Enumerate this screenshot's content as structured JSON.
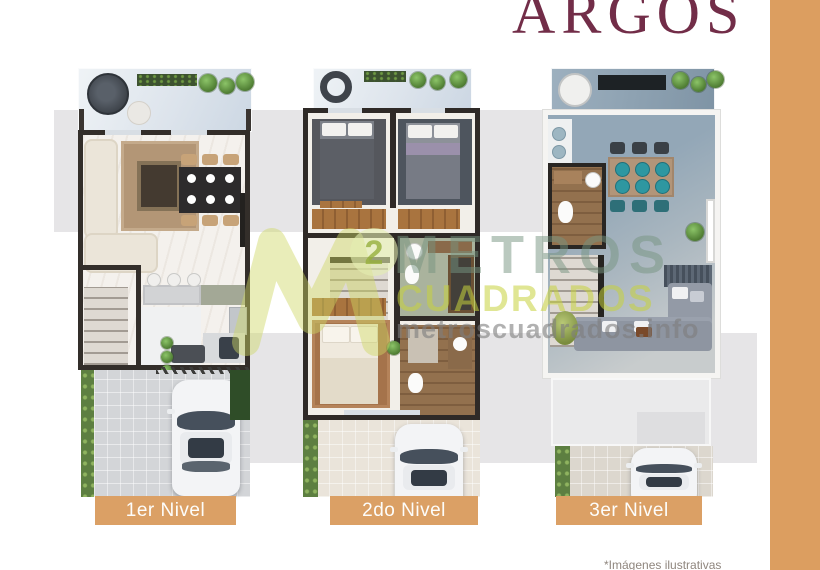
{
  "title": {
    "text": "ARGOS"
  },
  "watermark": {
    "logo_sup": "2",
    "line1": "METROS",
    "line2": "CUADRADOS",
    "url": "metroscuadrados.info"
  },
  "plans": [
    {
      "label": "1er Nivel"
    },
    {
      "label": "2do Nivel"
    },
    {
      "label": "3er Nivel"
    }
  ],
  "footnote": {
    "text": "*Imágenes ilustrativas"
  },
  "colors": {
    "accent_bar": "#DC9E60",
    "label_bg": "#DBA065",
    "title": "#722D48",
    "band_gray": "#E6E5E7",
    "watermark_green": "#76947F",
    "watermark_yellow": "#C6D23C",
    "terrace_blue": "#9FB1BF"
  }
}
